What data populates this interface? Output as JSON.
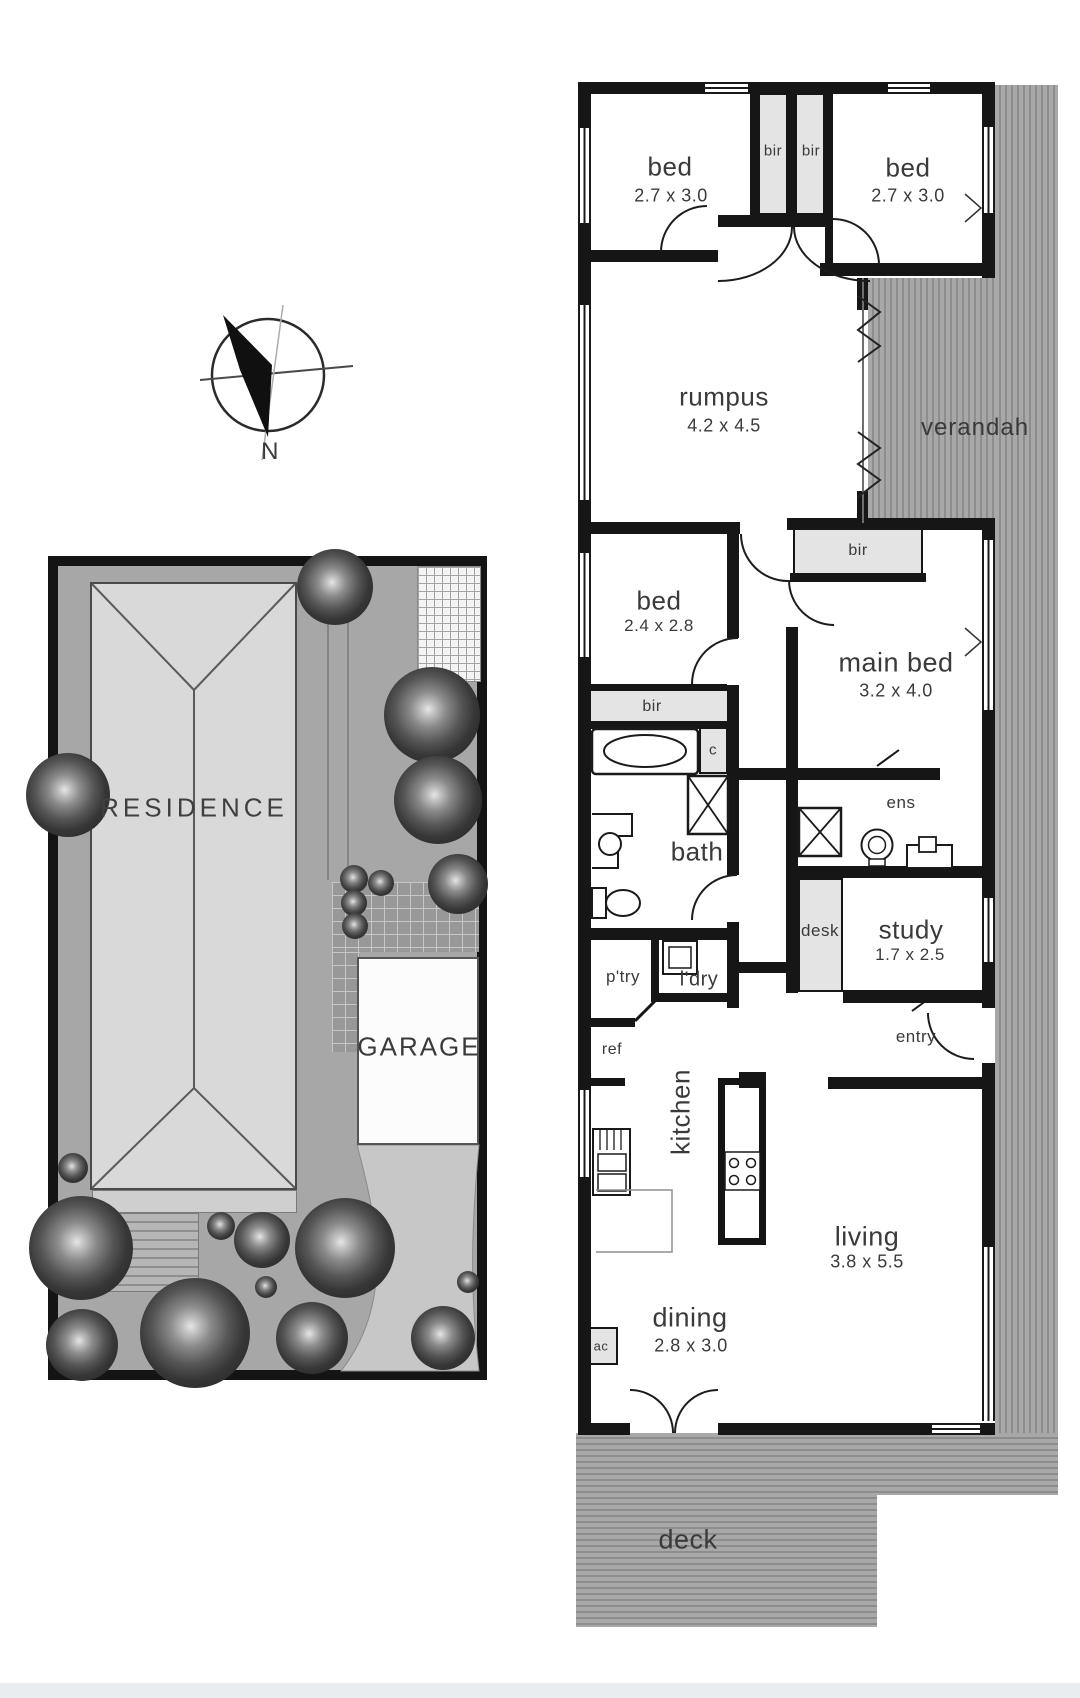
{
  "floor_plan": {
    "rooms": {
      "bed1": {
        "name": "bed",
        "dims": "2.7 x 3.0"
      },
      "bed2": {
        "name": "bed",
        "dims": "2.7 x 3.0"
      },
      "bed3": {
        "name": "bed",
        "dims": "2.4 x 2.8"
      },
      "main_bed": {
        "name": "main bed",
        "dims": "3.2 x 4.0"
      },
      "rumpus": {
        "name": "rumpus",
        "dims": "4.2 x 4.5"
      },
      "study": {
        "name": "study",
        "dims": "1.7 x 2.5"
      },
      "living": {
        "name": "living",
        "dims": "3.8 x 5.5"
      },
      "dining": {
        "name": "dining",
        "dims": "2.8 x 3.0"
      },
      "verandah": {
        "name": "verandah"
      },
      "deck": {
        "name": "deck"
      },
      "bath": {
        "name": "bath"
      },
      "ens": {
        "name": "ens"
      },
      "entry": {
        "name": "entry"
      },
      "kitchen": {
        "name": "kitchen"
      },
      "pantry": {
        "name": "p'try"
      },
      "laundry": {
        "name": "l'dry"
      },
      "ref": {
        "name": "ref"
      },
      "desk": {
        "name": "desk"
      },
      "closet": {
        "name": "c"
      },
      "ac": {
        "name": "ac"
      },
      "bir": {
        "name": "bir"
      }
    }
  },
  "site_plan": {
    "residence": "RESIDENCE",
    "garage": "GARAGE"
  },
  "compass": {
    "north": "N"
  },
  "colors": {
    "wall": "#161616",
    "stripe_base": "#a8a8a8",
    "stripe_line": "#8d8d8d",
    "closet_fill": "#e4e4e4",
    "site_ground": "#a7a7a7",
    "building_fill": "#d9d9d9",
    "label": "#3a3a3a"
  }
}
